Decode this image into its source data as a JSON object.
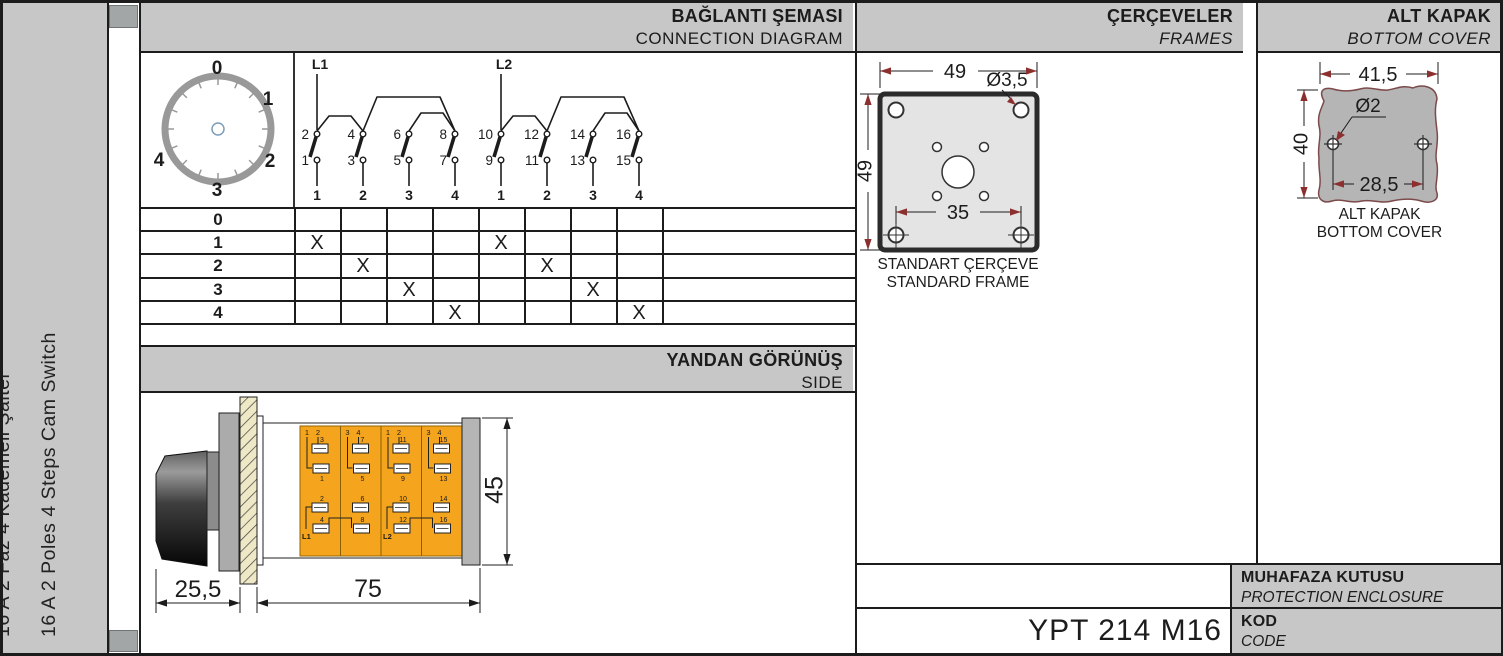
{
  "sidebar": {
    "line_tr": "16 A 2 Faz 4 Kademeli Şalter",
    "line_en": "16 A 2 Poles 4 Steps Cam Switch"
  },
  "sections": {
    "connection": {
      "title_tr": "BAĞLANTI ŞEMASI",
      "title_en": "CONNECTION DIAGRAM"
    },
    "side": {
      "title_tr": "YANDAN GÖRÜNÜŞ",
      "title_en": "SIDE"
    },
    "frames": {
      "title_tr": "ÇERÇEVELER",
      "title_en": "FRAMES"
    },
    "bottom_cover": {
      "title_tr": "ALT KAPAK",
      "title_en": "BOTTOM COVER"
    }
  },
  "dial": {
    "positions": [
      "0",
      "1",
      "2",
      "3",
      "4"
    ]
  },
  "contacts": {
    "groups": [
      {
        "feed": "L1",
        "switches": [
          {
            "top": "2",
            "bottom": "1",
            "pole": "1"
          },
          {
            "top": "4",
            "bottom": "3",
            "pole": "2"
          },
          {
            "top": "6",
            "bottom": "5",
            "pole": "3"
          },
          {
            "top": "8",
            "bottom": "7",
            "pole": "4"
          }
        ]
      },
      {
        "feed": "L2",
        "switches": [
          {
            "top": "10",
            "bottom": "9",
            "pole": "1"
          },
          {
            "top": "12",
            "bottom": "11",
            "pole": "2"
          },
          {
            "top": "14",
            "bottom": "13",
            "pole": "3"
          },
          {
            "top": "16",
            "bottom": "15",
            "pole": "4"
          }
        ]
      }
    ]
  },
  "truth_table": {
    "rows": [
      {
        "label": "0",
        "marks": [
          "",
          "",
          "",
          "",
          "",
          "",
          "",
          ""
        ]
      },
      {
        "label": "1",
        "marks": [
          "X",
          "",
          "",
          "",
          "X",
          "",
          "",
          ""
        ]
      },
      {
        "label": "2",
        "marks": [
          "",
          "X",
          "",
          "",
          "",
          "X",
          "",
          ""
        ]
      },
      {
        "label": "3",
        "marks": [
          "",
          "",
          "X",
          "",
          "",
          "",
          "X",
          ""
        ]
      },
      {
        "label": "4",
        "marks": [
          "",
          "",
          "",
          "X",
          "",
          "",
          "",
          "X"
        ]
      }
    ]
  },
  "side_view": {
    "dim_knob": "25,5",
    "dim_body": "75",
    "dim_height": "45",
    "stages": [
      {
        "top_pair": [
          "1",
          "2"
        ],
        "upper": [
          "3",
          "1"
        ],
        "lower": [
          "2",
          "4"
        ],
        "feed": "L1"
      },
      {
        "top_pair": [
          "3",
          "4"
        ],
        "upper": [
          "7",
          "5"
        ],
        "lower": [
          "6",
          "8"
        ],
        "feed": ""
      },
      {
        "top_pair": [
          "1",
          "2"
        ],
        "upper": [
          "11",
          "9"
        ],
        "lower": [
          "10",
          "12"
        ],
        "feed": "L2"
      },
      {
        "top_pair": [
          "3",
          "4"
        ],
        "upper": [
          "15",
          "13"
        ],
        "lower": [
          "14",
          "16"
        ],
        "feed": ""
      }
    ]
  },
  "frame": {
    "dim_width": "49",
    "dim_height": "49",
    "dim_hole": "Ø3,5",
    "dim_inner": "35",
    "caption_tr": "STANDART ÇERÇEVE",
    "caption_en": "STANDARD FRAME"
  },
  "cover": {
    "dim_width": "41,5",
    "dim_height": "40",
    "dim_hole": "Ø2",
    "dim_inner": "28,5",
    "caption_tr": "ALT KAPAK",
    "caption_en": "BOTTOM COVER"
  },
  "title_block": {
    "enclosure_tr": "MUHAFAZA KUTUSU",
    "enclosure_en": "PROTECTION ENCLOSURE",
    "code_tr": "KOD",
    "code_en": "CODE",
    "code_value": "YPT 214 M16"
  },
  "colors": {
    "accent_orange": "#f4a41d",
    "panel_gray": "#c7c7c7",
    "terminal_label_blue": "#8494a6",
    "arrow_red": "#8c2f2f"
  }
}
